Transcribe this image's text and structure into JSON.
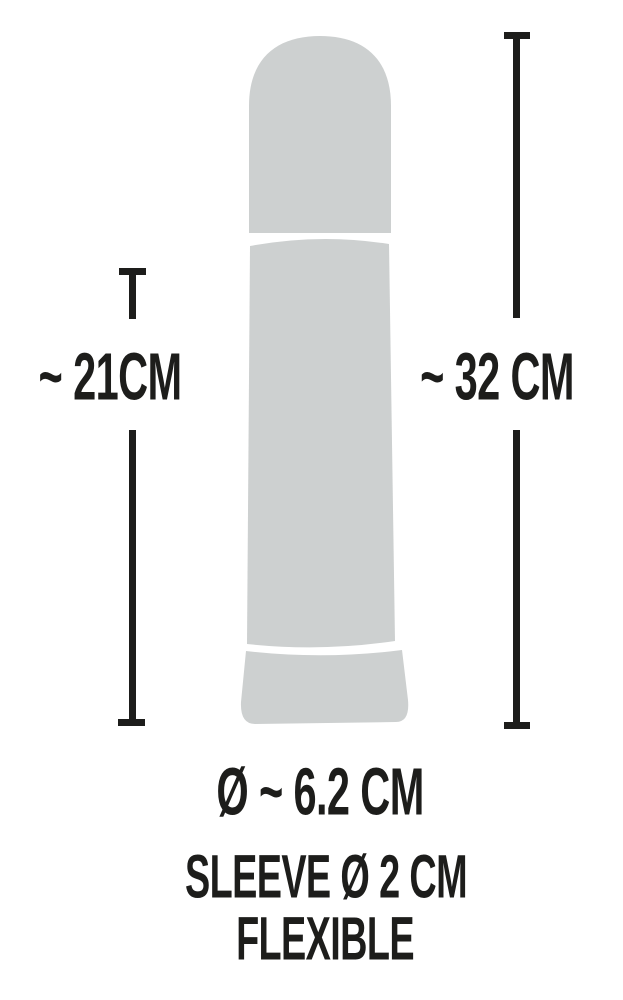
{
  "diagram": {
    "left_dimension": {
      "label": "~ 21CM",
      "value_cm": 21
    },
    "right_dimension": {
      "label": "~ 32 CM",
      "value_cm": 32
    },
    "diameter": {
      "label": "Ø ~ 6.2 CM",
      "value_cm": 6.2
    },
    "sleeve": {
      "label": "SLEEVE Ø 2 CM",
      "value_cm": 2
    },
    "flexible": {
      "label": "FLEXIBLE"
    }
  },
  "colors": {
    "background": "#ffffff",
    "silhouette": "#cdd0d0",
    "ink": "#1d1d1b"
  }
}
